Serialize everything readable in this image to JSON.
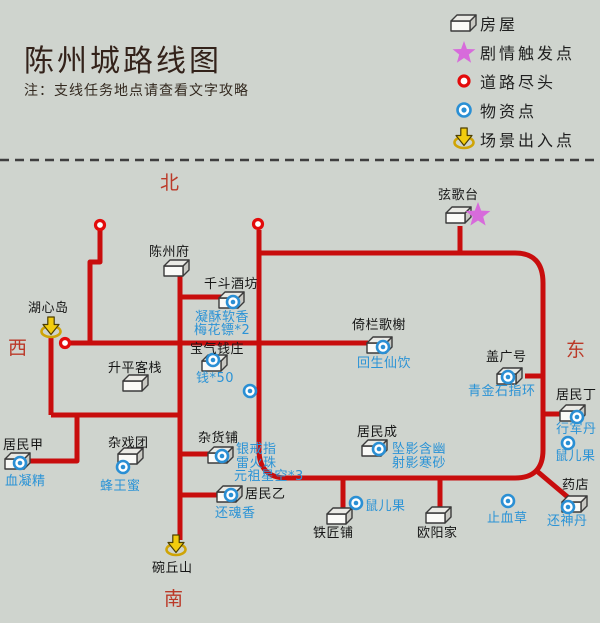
{
  "header": {
    "title": "陈州城路线图",
    "note": "注：支线任务地点请查看文字攻略"
  },
  "legend": {
    "items": [
      {
        "icon": "house",
        "label": "房屋"
      },
      {
        "icon": "star",
        "label": "剧情触发点"
      },
      {
        "icon": "road-end",
        "label": "道路尽头"
      },
      {
        "icon": "supply",
        "label": "物资点"
      },
      {
        "icon": "exit",
        "label": "场景出入点"
      }
    ]
  },
  "compass": {
    "north": "北",
    "west": "西",
    "east": "东",
    "south": "南"
  },
  "colors": {
    "background": "#cfd4ce",
    "road": "#c80d0d",
    "road_end": "#e30b0b",
    "supply_blue": "#2a8fd4",
    "item_text": "#2b93d6",
    "place_text": "#161616",
    "star_pink": "#d76bdb",
    "exit_yellow": "#f2cc0e",
    "compass_red": "#bb3928",
    "divider": "#3f3f3f"
  },
  "map": {
    "divider_y": 160,
    "roads": [
      {
        "d": "M100,228 V262 H90 V341"
      },
      {
        "d": "M66,343 H368"
      },
      {
        "d": "M51,336 V415"
      },
      {
        "d": "M51,415 H182"
      },
      {
        "d": "M77,415 V461 H30"
      },
      {
        "d": "M180,276 V540"
      },
      {
        "d": "M180,297 H228"
      },
      {
        "d": "M180,454 H213"
      },
      {
        "d": "M180,495 H224"
      },
      {
        "d": "M259,230 V450 Q259,478 287,478 H515 Q543,478 543,450 V283 Q543,253 515,253 H259"
      },
      {
        "d": "M460,226 V255"
      },
      {
        "d": "M525,376 H543"
      },
      {
        "d": "M543,414 H560"
      },
      {
        "d": "M343,478 V510"
      },
      {
        "d": "M440,478 V509"
      },
      {
        "d": "M538,472 L570,499"
      }
    ],
    "road_ends": [
      {
        "x": 100,
        "y": 225
      },
      {
        "x": 65,
        "y": 343
      },
      {
        "x": 258,
        "y": 224
      }
    ],
    "stars": [
      {
        "x": 478,
        "y": 215
      }
    ],
    "supply_points": [
      {
        "x": 250,
        "y": 391
      },
      {
        "x": 568,
        "y": 443,
        "label": {
          "text": "鼠儿果",
          "x": 555,
          "y": 450
        }
      },
      {
        "x": 356,
        "y": 503,
        "label": {
          "text": "鼠儿果",
          "x": 365,
          "y": 500
        }
      },
      {
        "x": 508,
        "y": 501,
        "label": {
          "text": "止血草",
          "x": 487,
          "y": 512
        }
      }
    ],
    "exits": [
      {
        "arrow": {
          "x": 51,
          "y": 328
        },
        "label": {
          "text": "湖心岛",
          "x": 28,
          "y": 302
        }
      },
      {
        "arrow": {
          "x": 176,
          "y": 546
        },
        "label": {
          "text": "碗丘山",
          "x": 152,
          "y": 562
        }
      }
    ],
    "houses": [
      {
        "x": 459,
        "y": 215,
        "label": {
          "text": "弦歌台",
          "x": 438,
          "y": 189
        },
        "supply": null,
        "items": []
      },
      {
        "x": 177,
        "y": 268,
        "label": {
          "text": "陈州府",
          "x": 149,
          "y": 246
        },
        "supply": null,
        "items": []
      },
      {
        "x": 232,
        "y": 300,
        "label": {
          "text": "千斗酒坊",
          "x": 204,
          "y": 278
        },
        "supply": {
          "x": 233,
          "y": 302
        },
        "items": [
          {
            "text": "凝酥软香",
            "x": 195,
            "y": 311
          },
          {
            "text": "梅花镖*2",
            "x": 194,
            "y": 324
          }
        ]
      },
      {
        "x": 215,
        "y": 363,
        "label": {
          "text": "宝气钱庄",
          "x": 190,
          "y": 343
        },
        "supply": {
          "x": 213,
          "y": 360
        },
        "items": [
          {
            "text": "钱*50",
            "x": 196,
            "y": 372
          }
        ]
      },
      {
        "x": 136,
        "y": 383,
        "label": {
          "text": "升平客栈",
          "x": 108,
          "y": 362
        },
        "supply": null,
        "items": []
      },
      {
        "x": 380,
        "y": 345,
        "label": {
          "text": "倚栏歌榭",
          "x": 352,
          "y": 319
        },
        "supply": {
          "x": 383,
          "y": 347
        },
        "items": [
          {
            "text": "回生仙饮",
            "x": 357,
            "y": 357
          }
        ]
      },
      {
        "x": 510,
        "y": 376,
        "label": {
          "text": "盖广号",
          "x": 486,
          "y": 351
        },
        "supply": {
          "x": 508,
          "y": 377
        },
        "items": [
          {
            "text": "青金石指环",
            "x": 468,
            "y": 385
          }
        ]
      },
      {
        "x": 573,
        "y": 413,
        "label": {
          "text": "居民丁",
          "x": 556,
          "y": 389
        },
        "supply": {
          "x": 577,
          "y": 417
        },
        "items": [
          {
            "text": "行军丹",
            "x": 556,
            "y": 423
          }
        ]
      },
      {
        "x": 18,
        "y": 461,
        "label": {
          "text": "居民甲",
          "x": 3,
          "y": 439
        },
        "supply": {
          "x": 20,
          "y": 463
        },
        "items": [
          {
            "text": "血凝精",
            "x": 5,
            "y": 475
          }
        ]
      },
      {
        "x": 131,
        "y": 456,
        "label": {
          "text": "杂戏团",
          "x": 108,
          "y": 437
        },
        "supply": {
          "x": 123,
          "y": 467
        },
        "items": [
          {
            "text": "蜂王蜜",
            "x": 100,
            "y": 480
          }
        ]
      },
      {
        "x": 221,
        "y": 455,
        "label": {
          "text": "杂货铺",
          "x": 198,
          "y": 432
        },
        "supply": {
          "x": 222,
          "y": 456
        },
        "items": [
          {
            "text": "银戒指",
            "x": 236,
            "y": 443
          },
          {
            "text": "雷火珠",
            "x": 236,
            "y": 457
          },
          {
            "text": "元祖星空*3",
            "x": 234,
            "y": 470
          }
        ]
      },
      {
        "x": 375,
        "y": 448,
        "label": {
          "text": "居民成",
          "x": 357,
          "y": 426
        },
        "supply": {
          "x": 379,
          "y": 449
        },
        "items": [
          {
            "text": "坠影含幽",
            "x": 392,
            "y": 443
          },
          {
            "text": "射影寒砂",
            "x": 392,
            "y": 457
          }
        ]
      },
      {
        "x": 230,
        "y": 494,
        "label": {
          "text": "居民乙",
          "x": 245,
          "y": 488
        },
        "supply": {
          "x": 231,
          "y": 495
        },
        "items": [
          {
            "text": "还魂香",
            "x": 215,
            "y": 507
          }
        ]
      },
      {
        "x": 340,
        "y": 516,
        "label": {
          "text": "铁匠铺",
          "x": 313,
          "y": 527
        },
        "supply": null,
        "items": []
      },
      {
        "x": 439,
        "y": 515,
        "label": {
          "text": "欧阳家",
          "x": 417,
          "y": 527
        },
        "supply": null,
        "items": []
      },
      {
        "x": 575,
        "y": 504,
        "label": {
          "text": "药店",
          "x": 562,
          "y": 479
        },
        "supply": {
          "x": 568,
          "y": 507
        },
        "items": [
          {
            "text": "还神丹",
            "x": 547,
            "y": 515
          }
        ]
      }
    ]
  }
}
